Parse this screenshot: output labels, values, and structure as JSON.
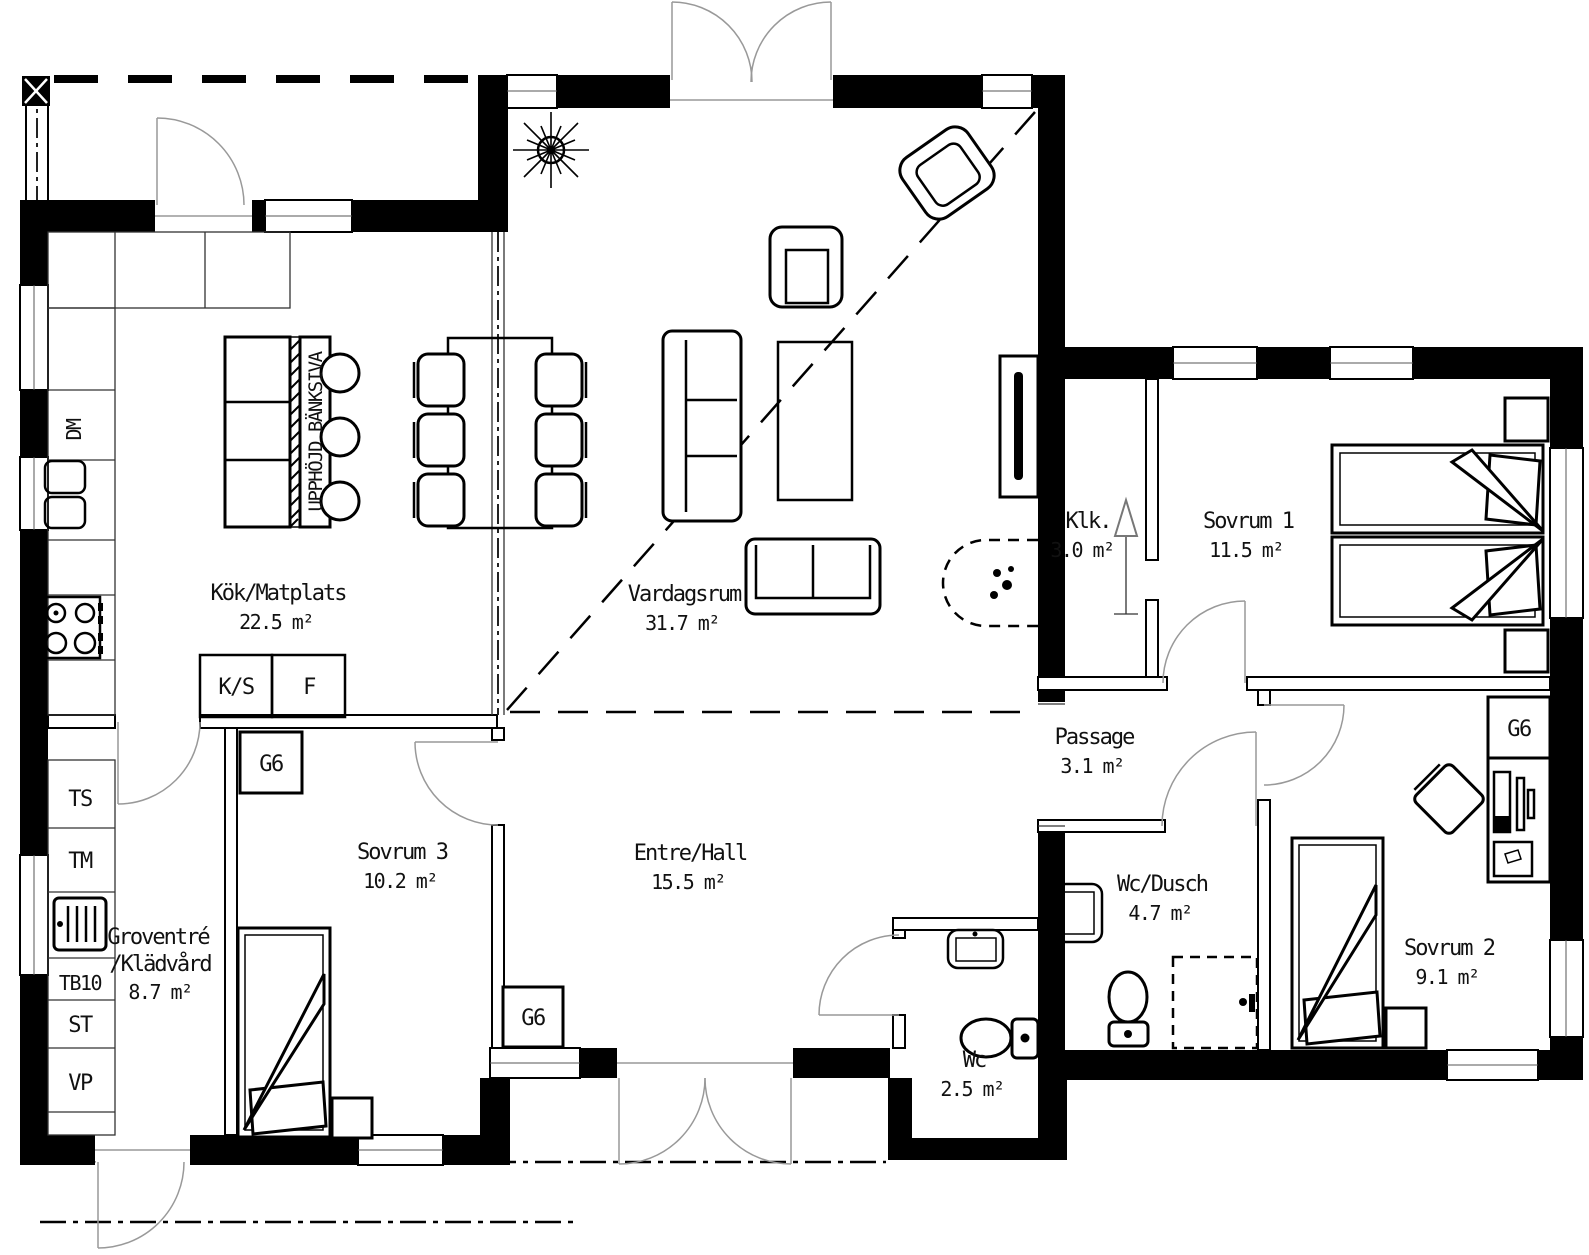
{
  "plan": {
    "rooms": [
      {
        "name": "Kök/Matplats",
        "area": "22.5 m²"
      },
      {
        "name": "Vardagsrum",
        "area": "31.7 m²"
      },
      {
        "name": "Sovrum 1",
        "area": "11.5 m²"
      },
      {
        "name": "Klk.",
        "area": "3.0 m²"
      },
      {
        "name": "Passage",
        "area": "3.1 m²"
      },
      {
        "name": "Sovrum 3",
        "area": "10.2 m²"
      },
      {
        "name": "Entre/Hall",
        "area": "15.5 m²"
      },
      {
        "name": "Groventré",
        "name_line2": "/Klädvård",
        "area": "8.7 m²"
      },
      {
        "name": "Wc/Dusch",
        "area": "4.7 m²"
      },
      {
        "name": "Sovrum 2",
        "area": "9.1 m²"
      },
      {
        "name": "Wc",
        "area": "2.5 m²"
      }
    ],
    "fixtures": {
      "dishwasher": "DM",
      "island_note": "UPPHÖJD BÄNKSIVA",
      "fridge": "K/S",
      "freezer": "F",
      "wardrobe": "G6",
      "ts": "TS",
      "tm": "TM",
      "tb10": "TB10",
      "st": "ST",
      "vp": "VP"
    },
    "colors": {
      "wall": "#000000",
      "background": "#ffffff",
      "doorline": "#999999"
    }
  }
}
